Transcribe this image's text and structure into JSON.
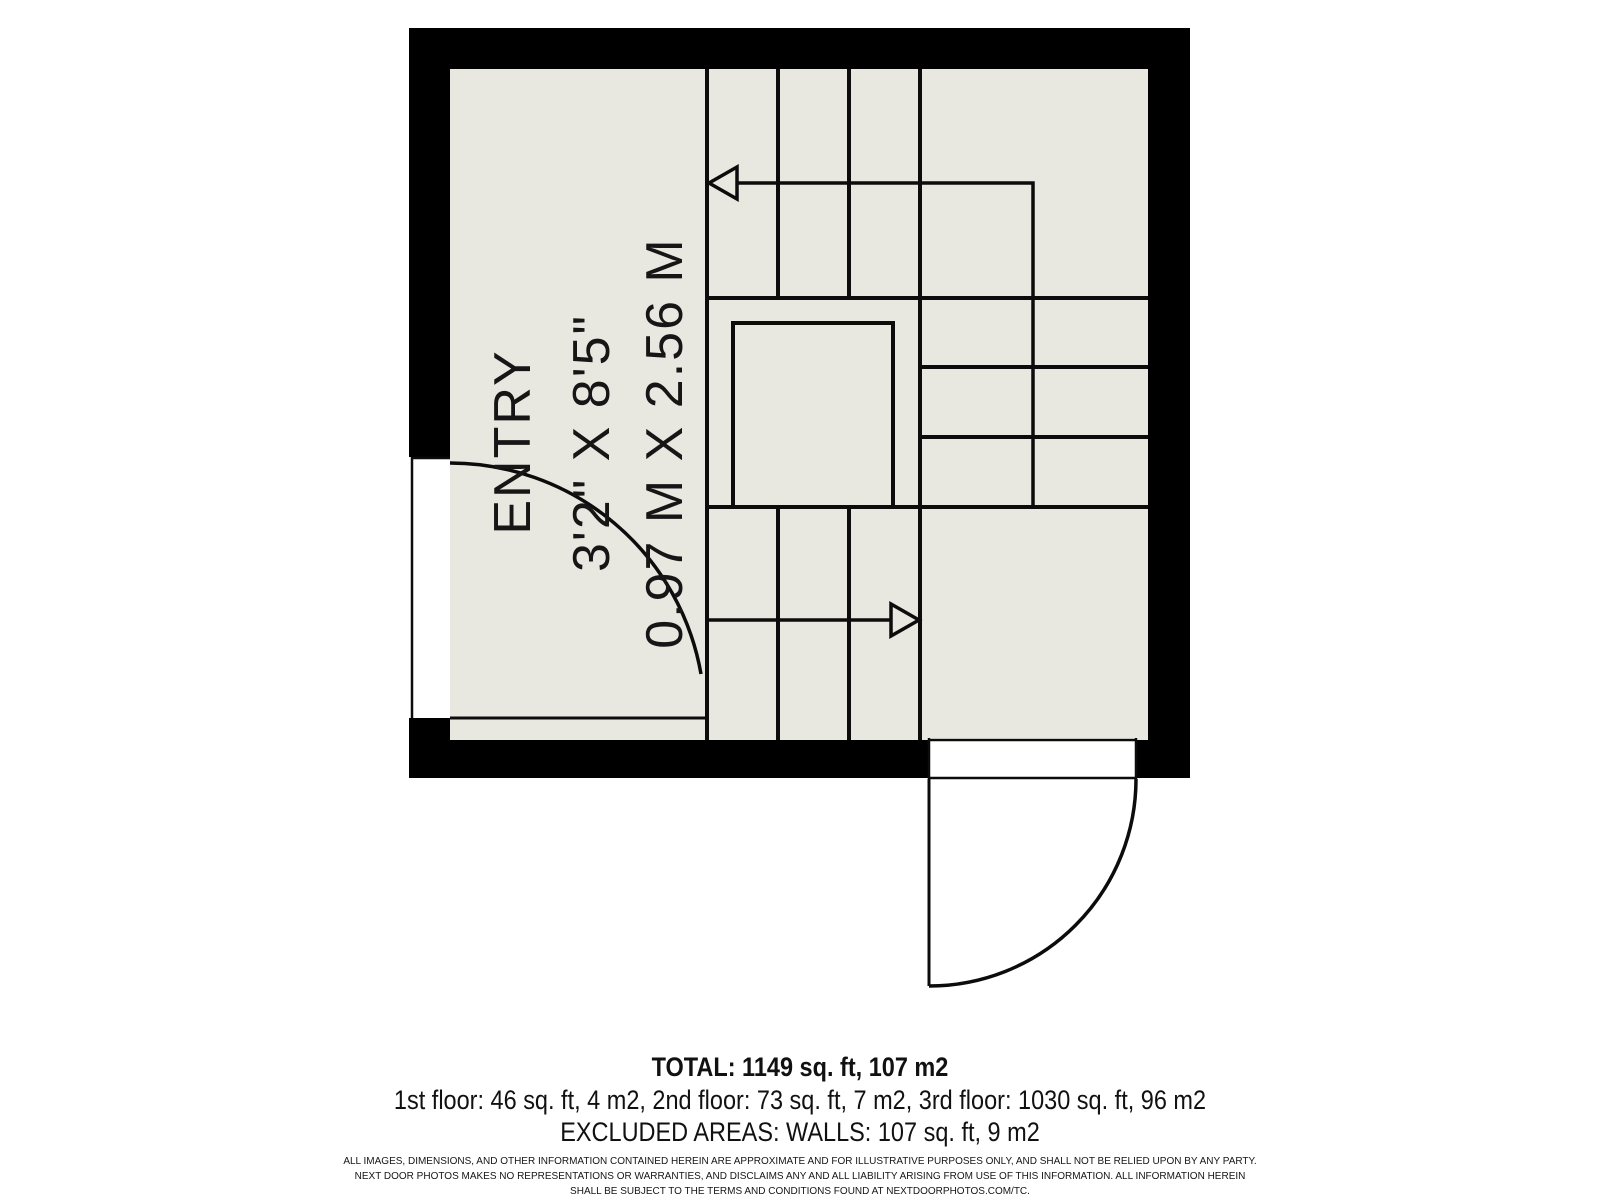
{
  "plan": {
    "room": {
      "name": "ENTRY",
      "dimensions_imperial": "3'2\" X 8'5\"",
      "dimensions_metric": "0.97 M X 2.56 M"
    },
    "colors": {
      "wall": "#000000",
      "floor": "#e9e8e0",
      "line": "#0c0c0c",
      "background": "#ffffff"
    }
  },
  "summary": {
    "total": "TOTAL: 1149 sq. ft, 107 m2",
    "floors": "1st floor: 46 sq. ft, 4 m2, 2nd floor: 73 sq. ft, 7 m2, 3rd floor: 1030 sq. ft, 96 m2",
    "excluded": "EXCLUDED AREAS: WALLS: 107 sq. ft, 9 m2"
  },
  "disclaimer": {
    "line1": "ALL IMAGES, DIMENSIONS, AND OTHER INFORMATION CONTAINED HEREIN ARE APPROXIMATE AND FOR ILLUSTRATIVE PURPOSES ONLY, AND SHALL NOT BE RELIED UPON BY ANY PARTY.",
    "line2": "NEXT DOOR PHOTOS MAKES NO REPRESENTATIONS OR WARRANTIES, AND DISCLAIMS ANY AND ALL LIABILITY ARISING FROM USE OF THIS INFORMATION. ALL INFORMATION HEREIN",
    "line3": "SHALL BE SUBJECT TO THE TERMS AND CONDITIONS FOUND AT NEXTDOORPHOTOS.COM/TC."
  }
}
